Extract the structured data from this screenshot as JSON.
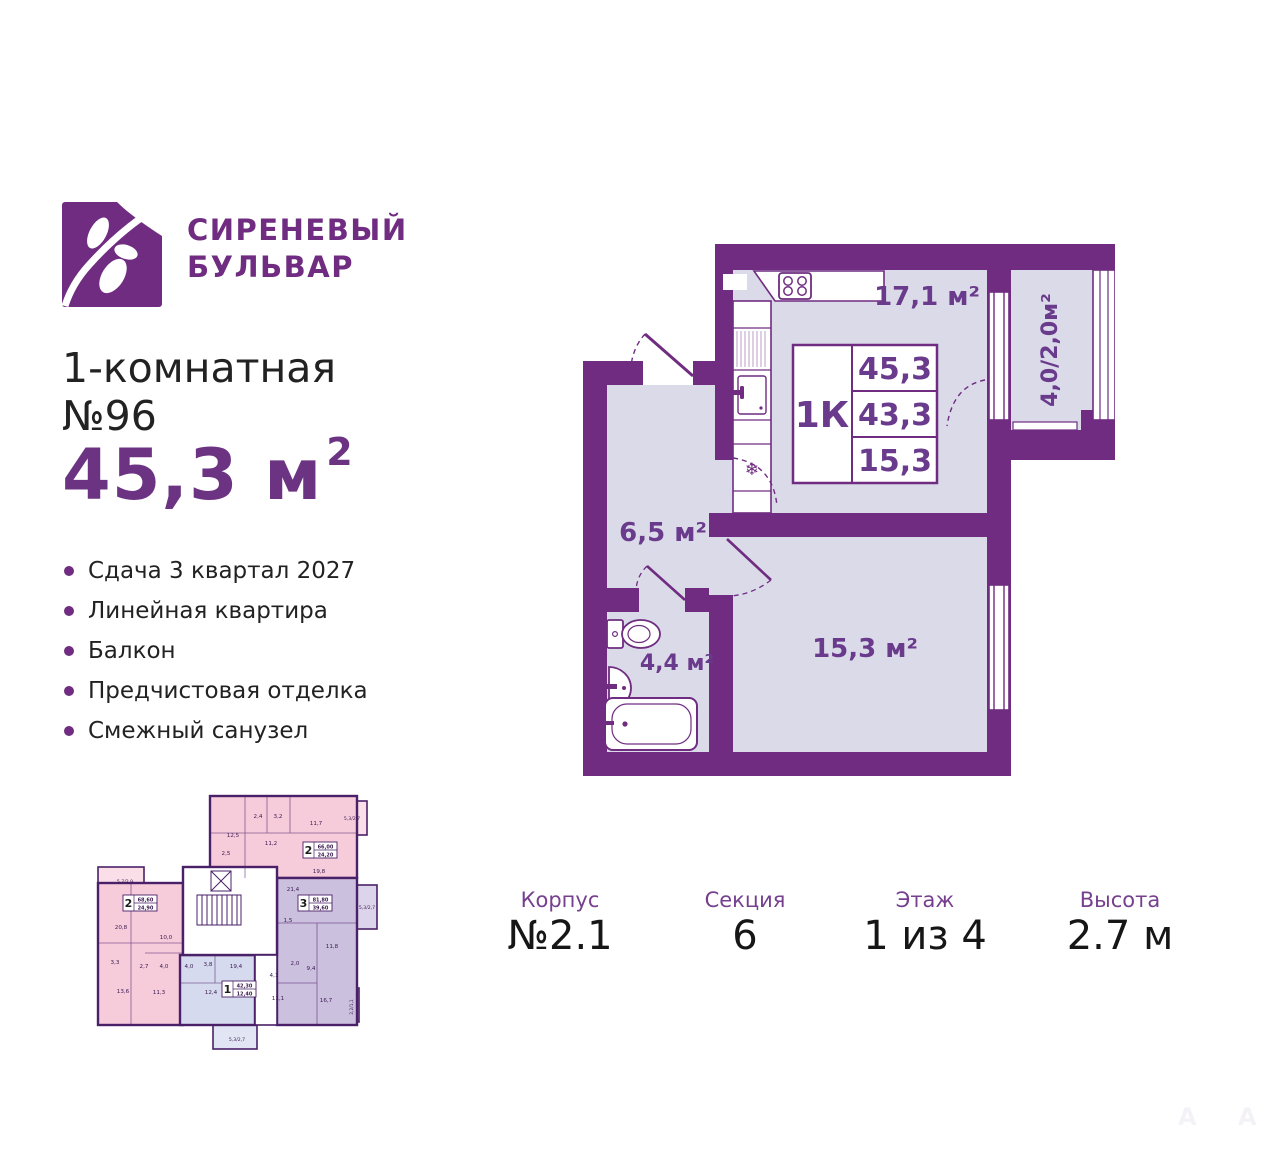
{
  "brand": {
    "line1": "СИРЕНЕВЫЙ",
    "line2": "БУЛЬВАР"
  },
  "listing": {
    "rooms_line": "1-комнатная",
    "number_line": "№96",
    "area": "45,3 м",
    "area_sup": "2"
  },
  "features": [
    "Сдача 3 квартал 2027",
    "Линейная квартира",
    "Балкон",
    "Предчистовая отделка",
    "Смежный санузел"
  ],
  "plan": {
    "kitchen_area": "17,1 м²",
    "hall_area": "6,5 м²",
    "bath_area": "4,4 м²",
    "room_area": "15,3 м²",
    "balcony_area": "4,0/2,0м²",
    "table": {
      "type": "1К",
      "total": "45,3",
      "living": "43,3",
      "room": "15,3"
    },
    "icons": {
      "snowflake": "❄"
    }
  },
  "miniplan": {
    "apartments": [
      {
        "num": "2",
        "area": "66,00",
        "living": "24,20"
      },
      {
        "num": "3",
        "area": "81,80",
        "living": "39,60"
      },
      {
        "num": "2",
        "area": "68,60",
        "living": "24,90"
      },
      {
        "num": "1",
        "area": "42,30",
        "living": "12,40"
      }
    ],
    "rooms": [
      "12,5",
      "2,4",
      "3,2",
      "11,2",
      "2,5",
      "11,7",
      "5,3/2,7",
      "19,8",
      "21,4",
      "1,5",
      "5,3/2,7",
      "11,8",
      "2,0",
      "9,4",
      "4,1",
      "11,1",
      "16,7",
      "2,2/1,1",
      "5,7/2,9",
      "20,8",
      "10,0",
      "3,3",
      "2,7",
      "4,0",
      "4,0",
      "3,8",
      "19,4",
      "13,6",
      "11,3",
      "12,4",
      "5,3/2,7"
    ]
  },
  "footer": [
    {
      "label": "Корпус",
      "value": "№2.1"
    },
    {
      "label": "Секция",
      "value": "6"
    },
    {
      "label": "Этаж",
      "value": "1 из 4"
    },
    {
      "label": "Высота",
      "value": "2.7 м"
    }
  ],
  "watermark": {
    "letter1": "А",
    "letter2": "А"
  }
}
